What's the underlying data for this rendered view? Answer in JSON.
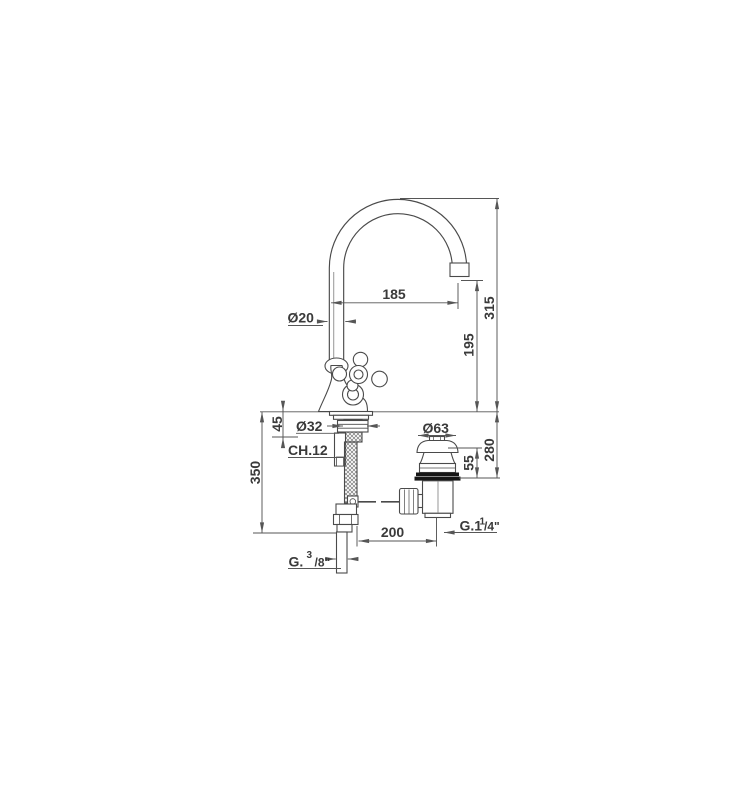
{
  "canvas": {
    "background": "#ffffff",
    "line_color": "#4a4a4a",
    "dim_color": "#565656",
    "text_color": "#3a3a3a",
    "flange_color": "#161616"
  },
  "labels": {
    "spout_reach": "185",
    "total_height": "315",
    "spout_diameter": "Ø20",
    "spout_height": "195",
    "shank_length": "45",
    "shank_diameter": "Ø32",
    "wrench_size": "CH.12",
    "hose_length": "350",
    "waste_diameter": "Ø63",
    "under_deck_depth": "280",
    "waste_height": "55",
    "horizontal_offset": "200",
    "waste_thread": {
      "prefix": "G.1",
      "sup": "1",
      "suffix": "/4\""
    },
    "supply_thread": {
      "prefix": "G.",
      "sup": "3",
      "suffix": "/8\""
    }
  }
}
